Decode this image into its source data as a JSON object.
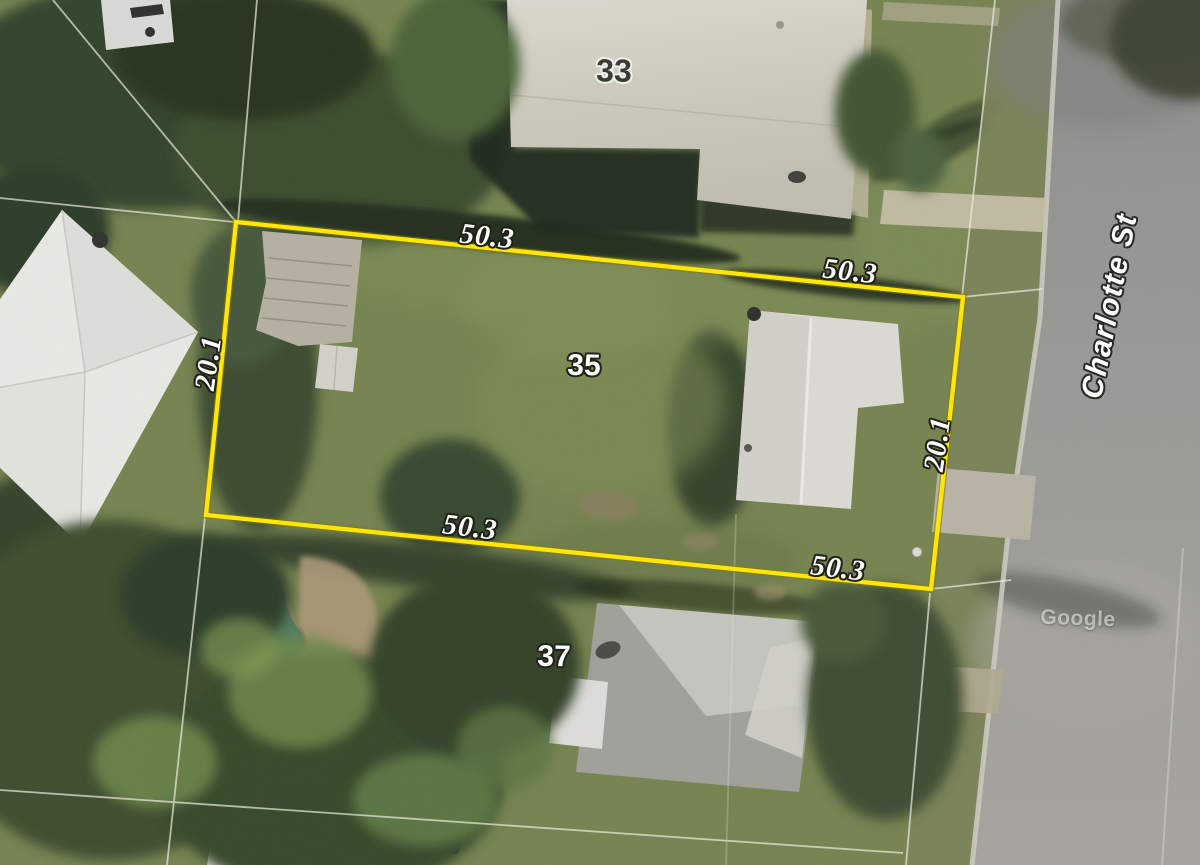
{
  "street": {
    "name": "Charlotte St"
  },
  "watermark": {
    "text": "Google"
  },
  "parcel_overlay": {
    "highlight_color": "#ffe60a",
    "subject_lot_number": "35",
    "north_lot_number": "33",
    "south_lot_number": "37",
    "dimensions": {
      "top_west": "50.3",
      "top_east": "50.3",
      "bottom_west": "50.3",
      "bottom_east": "50.3",
      "side_west": "20.1",
      "side_east": "20.1"
    }
  },
  "colors": {
    "grass_base": "#75834f",
    "road_surface": "#9a9a96",
    "roof_light": "#d9d6cd",
    "pool_water": "#4e7a63",
    "cadastral_line": "#ebebdf"
  }
}
